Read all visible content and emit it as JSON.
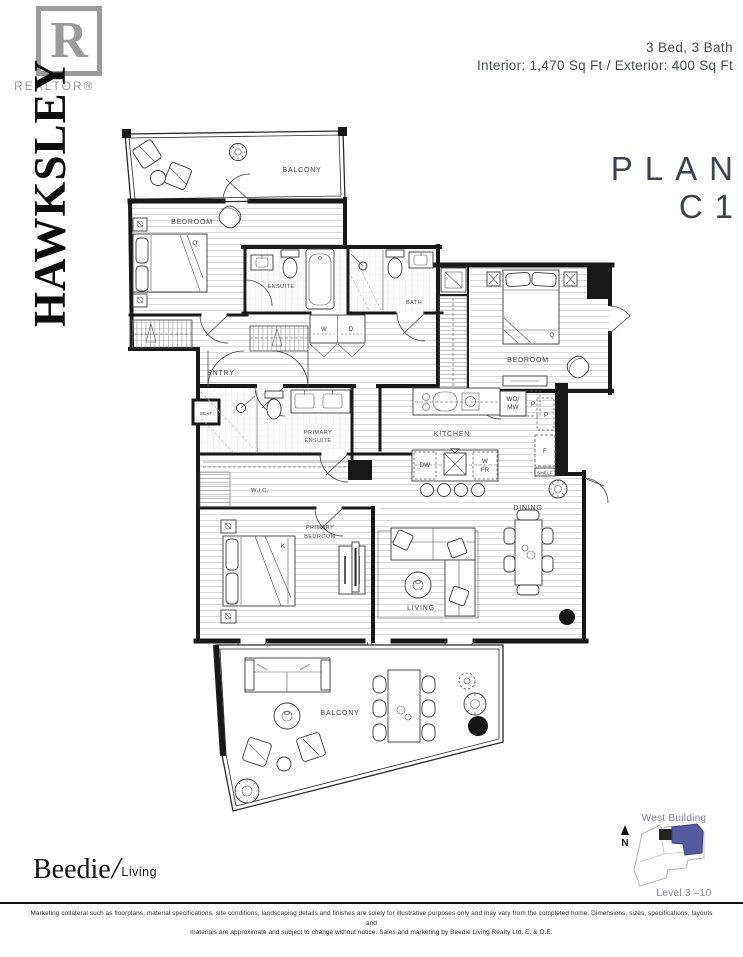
{
  "header": {
    "plan_name": "PLAN C1",
    "configuration": "3 Bed, 3 Bath",
    "area": "Interior: 1,470 Sq Ft  /  Exterior: 400 Sq Ft"
  },
  "branding": {
    "building_name": "HAWKSLEY",
    "realtor_r": "R",
    "realtor_label": "REALTOR®",
    "beedie_serif": "Beedie",
    "beedie_slash": "/",
    "beedie_sans": "Living"
  },
  "keyplan": {
    "building_label": "West Building",
    "level_label": "Level 3 –10",
    "compass_n": "N",
    "highlight_color": "#575aa1"
  },
  "rooms": {
    "balcony_top": "BALCONY",
    "bedroom_1": "BEDROOM",
    "ensuite": "ENSUITE",
    "bath": "BATH",
    "entry": "ENTRY",
    "seat": "SEAT",
    "primary_ensuite_l1": "PRIMARY",
    "primary_ensuite_l2": "ENSUITE",
    "wic": "W.I.C.",
    "primary_bedroom_l1": "PRIMARY",
    "primary_bedroom_l2": "BEDROOM",
    "kitchen": "KITCHEN",
    "living": "LIVING",
    "dining": "DINING",
    "bedroom_2": "BEDROOM",
    "balcony_bottom": "BALCONY"
  },
  "fixtures": {
    "washer": "W",
    "dryer": "D",
    "bed1_size": "Q",
    "bed2_size": "Q",
    "primary_bed_size": "K",
    "wall_oven_microwave_l1": "WO/",
    "wall_oven_microwave_l2": "MW",
    "pantry_1": "P",
    "pantry_2": "P",
    "dishwasher": "DW",
    "wine_fridge_l1": "W",
    "wine_fridge_l2": "FR",
    "fridge": "F",
    "shelf": "SHELF"
  },
  "footer": {
    "disclaimer_l1": "Marketing collateral such as floorplans, material specifications, site conditions, landscaping details and finishes are solely for illustrative purposes only and may vary from the completed home. Dimensions, sizes, specifications, layouts and",
    "disclaimer_l2": "materials are approximate and subject to change without notice. Sales and marketing by Beedie Living Realty Ltd. E. & O.E."
  }
}
